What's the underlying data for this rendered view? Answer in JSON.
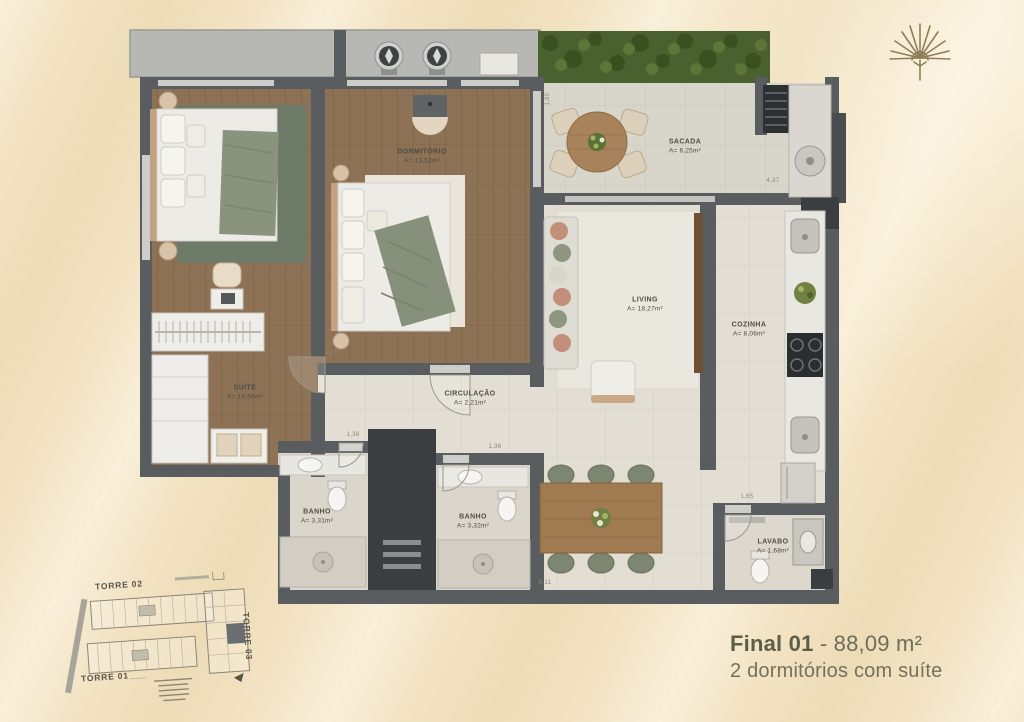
{
  "branding": {
    "logo": "sunburst-palm-icon"
  },
  "unit": {
    "title_bold": "Final 01",
    "title_rest": "- 88,09 m²",
    "subtitle": "2 dormitórios com suíte"
  },
  "rooms": [
    {
      "name": "SUÍTE",
      "area": "A= 16,66m²"
    },
    {
      "name": "DORMITÓRIO",
      "area": "A= 13,52m²"
    },
    {
      "name": "SACADA",
      "area": "A= 6,25m²"
    },
    {
      "name": "LIVING",
      "area": "A= 18,27m²"
    },
    {
      "name": "COZINHA",
      "area": "A= 8,06m²"
    },
    {
      "name": "CIRCULAÇÃO",
      "area": "A= 2,21m²"
    },
    {
      "name": "BANHO",
      "area": "A= 3,31m²"
    },
    {
      "name": "BANHO",
      "area": "A= 3,32m²"
    },
    {
      "name": "LAVABO",
      "area": "A= 1,68m²"
    }
  ],
  "dimensions": [
    {
      "text": "1,90"
    },
    {
      "text": "4,37"
    },
    {
      "text": "1,65"
    },
    {
      "text": "1,38"
    },
    {
      "text": "1,36"
    },
    {
      "text": "5,11"
    },
    {
      "text": "3,24"
    }
  ],
  "site_plan": {
    "towers": [
      {
        "label": "TORRE 02"
      },
      {
        "label": "TORRE 01"
      },
      {
        "label": "TORRE 03"
      }
    ]
  },
  "colors": {
    "background": "#f2e3c3",
    "wall": "#5a5d5f",
    "wood_floor": "#8d7255",
    "hedge_green": "#49602f",
    "caption_text": "#6e6d5a"
  }
}
